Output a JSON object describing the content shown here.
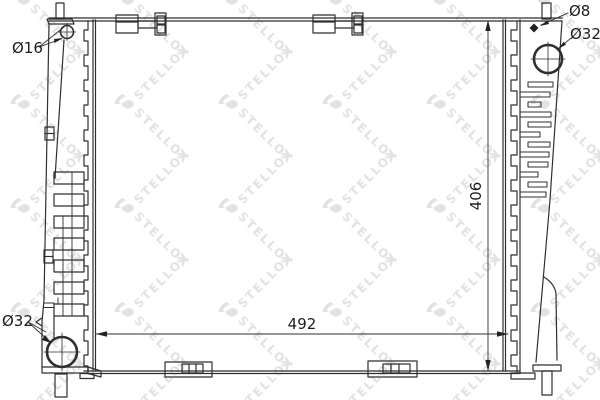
{
  "watermark": {
    "brand": "STELLOX",
    "logo_letter": "S",
    "color": "#e2e2e2"
  },
  "labels": {
    "top_left_hole": "Ø16",
    "top_right_hole": "Ø8",
    "right_port": "Ø32",
    "bottom_left_port": "Ø32"
  },
  "dimensions": {
    "core_height": "406",
    "core_width": "492"
  },
  "colors": {
    "line": "#2f2f2f",
    "background": "#ffffff"
  }
}
